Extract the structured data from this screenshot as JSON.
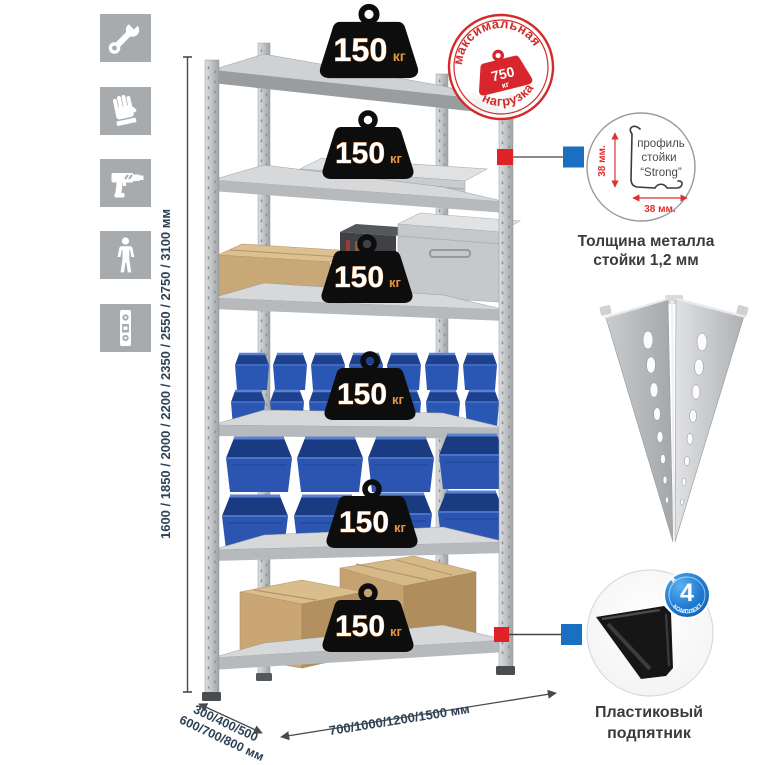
{
  "colors": {
    "accent_red": "#d8262c",
    "accent_blue": "#1b6fc0",
    "bin_blue": "#2b55b0",
    "icon_gray": "#a8abae",
    "dim_text": "#2e4257",
    "badge_black": "#0d0d0d"
  },
  "feature_icons": [
    {
      "name": "wrench-icon"
    },
    {
      "name": "gloves-icon"
    },
    {
      "name": "drill-icon"
    },
    {
      "name": "person-icon"
    },
    {
      "name": "level-icon"
    }
  ],
  "dimensions": {
    "height_label": "1600 / 1850 / 2000 / 2200 / 2350 / 2550 / 2750 / 3100 мм",
    "depth_label_line1": "300/400/500",
    "depth_label_line2": "600/700/800 мм",
    "width_label": "700/1000/1200/1500 мм"
  },
  "max_load_stamp": {
    "arc_top": "максимальная",
    "arc_bottom": "нагрузка",
    "value": "750",
    "unit": "кг"
  },
  "shelves": [
    {
      "load": "150",
      "unit": "кг"
    },
    {
      "load": "150",
      "unit": "кг"
    },
    {
      "load": "150",
      "unit": "кг"
    },
    {
      "load": "150",
      "unit": "кг"
    },
    {
      "load": "150",
      "unit": "кг"
    },
    {
      "load": "150",
      "unit": "кг"
    }
  ],
  "post_profile": {
    "label_line1": "профиль",
    "label_line2": "стойки",
    "label_line3": "“Strong”",
    "dim_vertical": "38 мм.",
    "dim_horizontal": "38 мм.",
    "caption_line1": "Толщина металла",
    "caption_line2": "стойки 1,2 мм"
  },
  "foot": {
    "badge_value": "4",
    "badge_ring_text": "В КОМПЛЕКТЕ",
    "caption_line1": "Пластиковый",
    "caption_line2": "подпятник"
  }
}
